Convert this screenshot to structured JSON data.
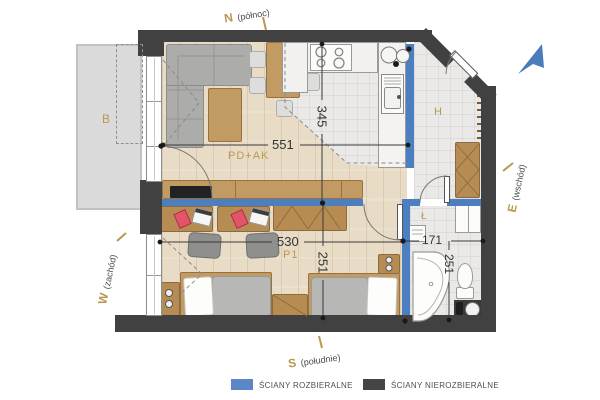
{
  "compass": {
    "north": {
      "letter": "N",
      "word": "(północ)"
    },
    "south": {
      "letter": "S",
      "word": "(południe)"
    },
    "east": {
      "letter": "E",
      "word": "(wschód)"
    },
    "west": {
      "letter": "W",
      "word": "(zachód)"
    }
  },
  "rooms": {
    "balcony": "B",
    "living_kitchen": "PD+AK",
    "bedroom": "P1",
    "hall": "H",
    "bathroom": "Ł"
  },
  "dimensions_cm": {
    "living_width": "551",
    "kitchen_depth": "345",
    "bedroom_width": "530",
    "bathroom_width": "171",
    "bedroom_depth": "251",
    "bathroom_depth": "251"
  },
  "legend": {
    "demountable": {
      "label": "ŚCIANY ROZBIERALNE",
      "color": "#5b87c8"
    },
    "non_demountable": {
      "label": "ŚCIANY NIEROZBIERALNE",
      "color": "#454545"
    }
  },
  "colors": {
    "wall_fixed": "#414141",
    "wall_demountable": "#4c7fc0",
    "floor_wood": "#e9dcc6",
    "floor_tile": "#eae9e7",
    "balcony_floor": "#dadada",
    "room_label": "#b8994e",
    "entrance_arrow": "#4c7cba"
  }
}
